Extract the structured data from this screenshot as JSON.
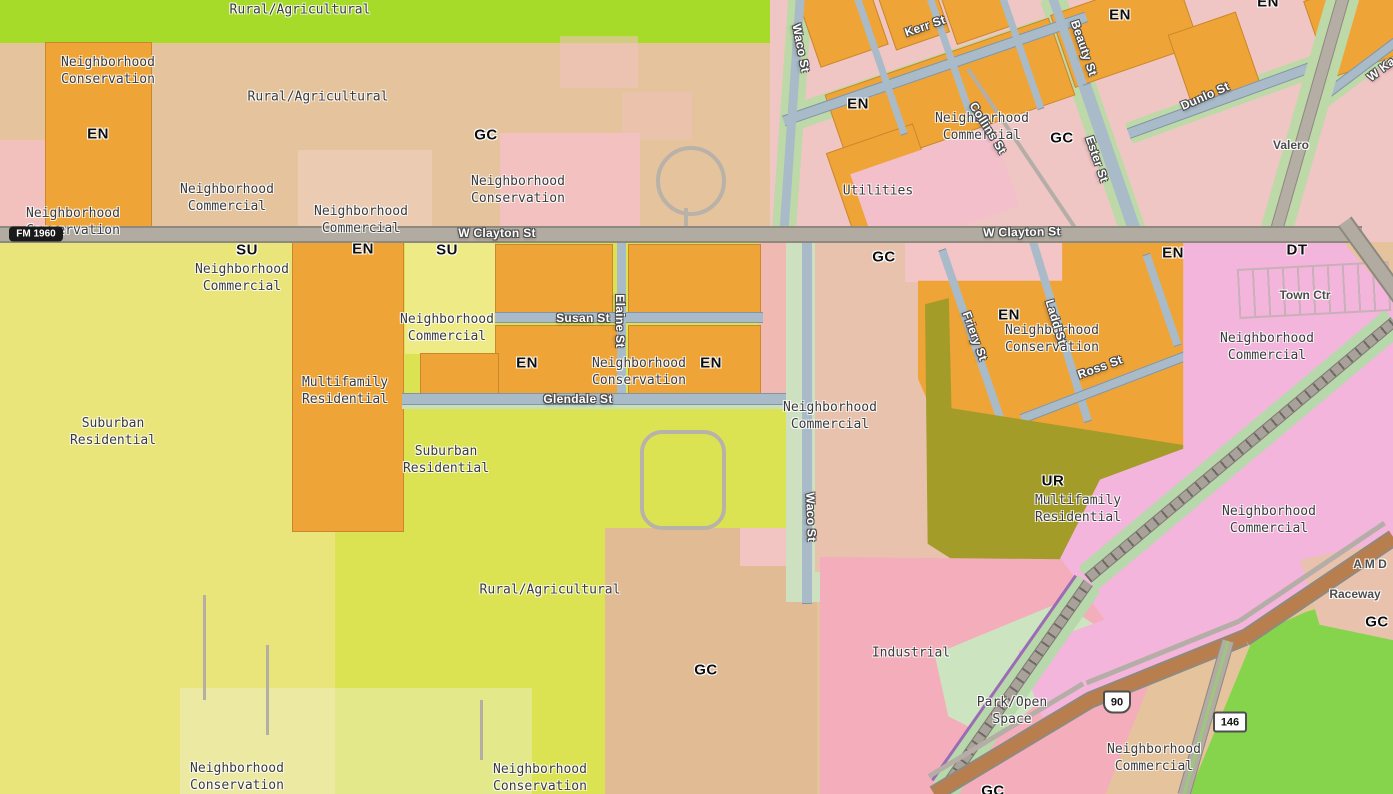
{
  "map": {
    "kind": "municipal zoning map",
    "colors": {
      "rural_agricultural_green": "#a7db2a",
      "rural_agricultural_tan": "#e5c39c",
      "neighborhood_conservation_orange": "#efa437",
      "neighborhood_commercial_pink": "#f3c3c2",
      "suburban_residential_yellow": "#eae57b",
      "suburban_residential_lime": "#dbe352",
      "multifamily_residential_olive": "#a49c29",
      "downtown_magenta": "#f3b5dc",
      "industrial_pink": "#f4aebb",
      "park_open_space_green": "#cde4c0",
      "general_commercial_tan": "#e1bb93",
      "street_blue": "#a9bbc9",
      "street_buffer_green": "#bdd9a8",
      "major_road_gray": "#b2aba1",
      "highway_brown": "#b97e4d",
      "railroad_gray": "#a8a29a"
    }
  },
  "labels": [
    {
      "text": "Rural/Agricultural",
      "x": 300,
      "y": 10,
      "rot": 0,
      "kind": "zone"
    },
    {
      "text": "Neighborhood\nConservation",
      "x": 108,
      "y": 71,
      "rot": 0,
      "kind": "zone"
    },
    {
      "text": "Rural/Agricultural",
      "x": 318,
      "y": 97,
      "rot": 0,
      "kind": "zone"
    },
    {
      "text": "Neighborhood\nCommercial",
      "x": 982,
      "y": 127,
      "rot": 0,
      "kind": "zone"
    },
    {
      "text": "Neighborhood\nCommercial",
      "x": 227,
      "y": 198,
      "rot": 0,
      "kind": "zone"
    },
    {
      "text": "Neighborhood\nConservation",
      "x": 518,
      "y": 190,
      "rot": 0,
      "kind": "zone"
    },
    {
      "text": "Neighborhood\nCommercial",
      "x": 361,
      "y": 220,
      "rot": 0,
      "kind": "zone"
    },
    {
      "text": "Neighborhood\nConservation",
      "x": 73,
      "y": 222,
      "rot": 0,
      "kind": "zone"
    },
    {
      "text": "Utilities",
      "x": 878,
      "y": 191,
      "rot": 0,
      "kind": "zone"
    },
    {
      "text": "Neighborhood\nCommercial",
      "x": 242,
      "y": 278,
      "rot": 0,
      "kind": "zone"
    },
    {
      "text": "Neighborhood\nCommercial",
      "x": 447,
      "y": 328,
      "rot": 0,
      "kind": "zone"
    },
    {
      "text": "Neighborhood\nConservation",
      "x": 639,
      "y": 372,
      "rot": 0,
      "kind": "zone"
    },
    {
      "text": "Multifamily\nResidential",
      "x": 345,
      "y": 391,
      "rot": 0,
      "kind": "zone"
    },
    {
      "text": "Suburban\nResidential",
      "x": 113,
      "y": 432,
      "rot": 0,
      "kind": "zone"
    },
    {
      "text": "Suburban\nResidential",
      "x": 446,
      "y": 460,
      "rot": 0,
      "kind": "zone"
    },
    {
      "text": "Neighborhood\nCommercial",
      "x": 830,
      "y": 416,
      "rot": 0,
      "kind": "zone"
    },
    {
      "text": "Neighborhood\nConservation",
      "x": 1052,
      "y": 339,
      "rot": 0,
      "kind": "zone"
    },
    {
      "text": "Neighborhood\nCommercial",
      "x": 1267,
      "y": 347,
      "rot": 0,
      "kind": "zone"
    },
    {
      "text": "Multifamily\nResidential",
      "x": 1078,
      "y": 509,
      "rot": 0,
      "kind": "zone"
    },
    {
      "text": "Neighborhood\nCommercial",
      "x": 1269,
      "y": 520,
      "rot": 0,
      "kind": "zone"
    },
    {
      "text": "Rural/Agricultural",
      "x": 550,
      "y": 590,
      "rot": 0,
      "kind": "zone"
    },
    {
      "text": "Industrial",
      "x": 911,
      "y": 653,
      "rot": 0,
      "kind": "zone"
    },
    {
      "text": "Park/Open\nSpace",
      "x": 1012,
      "y": 711,
      "rot": 0,
      "kind": "zone"
    },
    {
      "text": "Neighborhood\nCommercial",
      "x": 1154,
      "y": 758,
      "rot": 0,
      "kind": "zone"
    },
    {
      "text": "Neighborhood\nConservation",
      "x": 237,
      "y": 777,
      "rot": 0,
      "kind": "zone"
    },
    {
      "text": "Neighborhood\nConservation",
      "x": 540,
      "y": 778,
      "rot": 0,
      "kind": "zone"
    },
    {
      "text": "EN",
      "x": 98,
      "y": 134,
      "rot": 0,
      "kind": "code"
    },
    {
      "text": "EN",
      "x": 858,
      "y": 104,
      "rot": 0,
      "kind": "code"
    },
    {
      "text": "EN",
      "x": 1120,
      "y": 15,
      "rot": 0,
      "kind": "code"
    },
    {
      "text": "EN",
      "x": 1268,
      "y": 2,
      "rot": 0,
      "kind": "code"
    },
    {
      "text": "GC",
      "x": 486,
      "y": 135,
      "rot": 0,
      "kind": "code"
    },
    {
      "text": "GC",
      "x": 1062,
      "y": 138,
      "rot": 0,
      "kind": "code"
    },
    {
      "text": "SU",
      "x": 247,
      "y": 250,
      "rot": 0,
      "kind": "code"
    },
    {
      "text": "EN",
      "x": 363,
      "y": 249,
      "rot": 0,
      "kind": "code"
    },
    {
      "text": "SU",
      "x": 447,
      "y": 250,
      "rot": 0,
      "kind": "code"
    },
    {
      "text": "EN",
      "x": 527,
      "y": 363,
      "rot": 0,
      "kind": "code"
    },
    {
      "text": "EN",
      "x": 711,
      "y": 363,
      "rot": 0,
      "kind": "code"
    },
    {
      "text": "GC",
      "x": 884,
      "y": 257,
      "rot": 0,
      "kind": "code"
    },
    {
      "text": "EN",
      "x": 1009,
      "y": 315,
      "rot": 0,
      "kind": "code"
    },
    {
      "text": "EN",
      "x": 1173,
      "y": 253,
      "rot": 0,
      "kind": "code"
    },
    {
      "text": "DT",
      "x": 1297,
      "y": 250,
      "rot": 0,
      "kind": "code"
    },
    {
      "text": "UR",
      "x": 1053,
      "y": 481,
      "rot": 0,
      "kind": "code"
    },
    {
      "text": "GC",
      "x": 706,
      "y": 670,
      "rot": 0,
      "kind": "code"
    },
    {
      "text": "GC",
      "x": 1377,
      "y": 622,
      "rot": 0,
      "kind": "code"
    },
    {
      "text": "GC",
      "x": 993,
      "y": 791,
      "rot": 0,
      "kind": "code"
    },
    {
      "text": "W Clayton St",
      "x": 497,
      "y": 233,
      "rot": 0,
      "kind": "street"
    },
    {
      "text": "W Clayton St",
      "x": 1022,
      "y": 232,
      "rot": -1,
      "kind": "street"
    },
    {
      "text": "Waco St",
      "x": 801,
      "y": 48,
      "rot": 79,
      "kind": "street"
    },
    {
      "text": "Waco St",
      "x": 811,
      "y": 517,
      "rot": 88,
      "kind": "street"
    },
    {
      "text": "Kerr St",
      "x": 925,
      "y": 26,
      "rot": -19,
      "kind": "street"
    },
    {
      "text": "Beauty St",
      "x": 1084,
      "y": 48,
      "rot": 71,
      "kind": "street"
    },
    {
      "text": "Collins St",
      "x": 988,
      "y": 128,
      "rot": 58,
      "kind": "street"
    },
    {
      "text": "Ester St",
      "x": 1097,
      "y": 159,
      "rot": 71,
      "kind": "street"
    },
    {
      "text": "Dunlo St",
      "x": 1205,
      "y": 96,
      "rot": -24,
      "kind": "street"
    },
    {
      "text": "W Ka",
      "x": 1381,
      "y": 69,
      "rot": -37,
      "kind": "street"
    },
    {
      "text": "Susan St",
      "x": 583,
      "y": 318,
      "rot": 0,
      "kind": "street"
    },
    {
      "text": "Elaine St",
      "x": 620,
      "y": 321,
      "rot": 90,
      "kind": "street"
    },
    {
      "text": "Glendale St",
      "x": 578,
      "y": 399,
      "rot": 0,
      "kind": "street"
    },
    {
      "text": "Friery St",
      "x": 975,
      "y": 336,
      "rot": 70,
      "kind": "street"
    },
    {
      "text": "Ladd St",
      "x": 1056,
      "y": 322,
      "rot": 73,
      "kind": "street"
    },
    {
      "text": "Ross St",
      "x": 1100,
      "y": 367,
      "rot": -20,
      "kind": "street"
    },
    {
      "text": "Valero",
      "x": 1291,
      "y": 145,
      "rot": 0,
      "kind": "poi"
    },
    {
      "text": "Town Ctr",
      "x": 1305,
      "y": 295,
      "rot": 0,
      "kind": "poi"
    },
    {
      "text": "Raceway",
      "x": 1355,
      "y": 594,
      "rot": 0,
      "kind": "poi"
    },
    {
      "text": "A M D",
      "x": 1370,
      "y": 564,
      "rot": 0,
      "kind": "poi"
    }
  ],
  "shields": [
    {
      "type": "fm",
      "text": "FM 1960",
      "x": 36,
      "y": 234
    },
    {
      "type": "us",
      "text": "90",
      "x": 1117,
      "y": 702
    },
    {
      "type": "sh",
      "text": "146",
      "x": 1230,
      "y": 722
    }
  ]
}
